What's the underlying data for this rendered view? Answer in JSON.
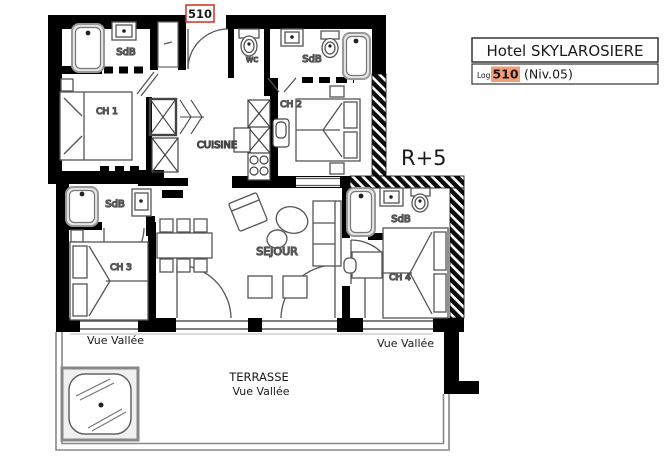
{
  "badge": {
    "unit_number": "510"
  },
  "info_box": {
    "hotel_name": "Hotel SKYLAROSIERE",
    "log_label": "Log",
    "unit_number": "510",
    "level": "(Niv.05)"
  },
  "floor_label": "R+5",
  "labels": {
    "ch1": "CH 1",
    "ch2": "CH 2",
    "ch3": "CH 3",
    "ch4": "CH 4",
    "sdb_top_left": "SdB",
    "sdb_top_right": "SdB",
    "sdb_mid_left": "SdB",
    "sdb_mid_right": "SdB",
    "wc": "wc",
    "cuisine": "CUISINE",
    "sejour": "SEJOUR",
    "terrasse": "TERRASSE",
    "vue_vallee_left": "Vue Vallée",
    "vue_vallee_right": "Vue Vallée",
    "vue_vallee_terrace": "Vue Vallée"
  },
  "colors": {
    "wall": "#000000",
    "accent_red": "#cf2e21",
    "unit_highlight": "#f49d77",
    "furniture_line": "#555555"
  }
}
